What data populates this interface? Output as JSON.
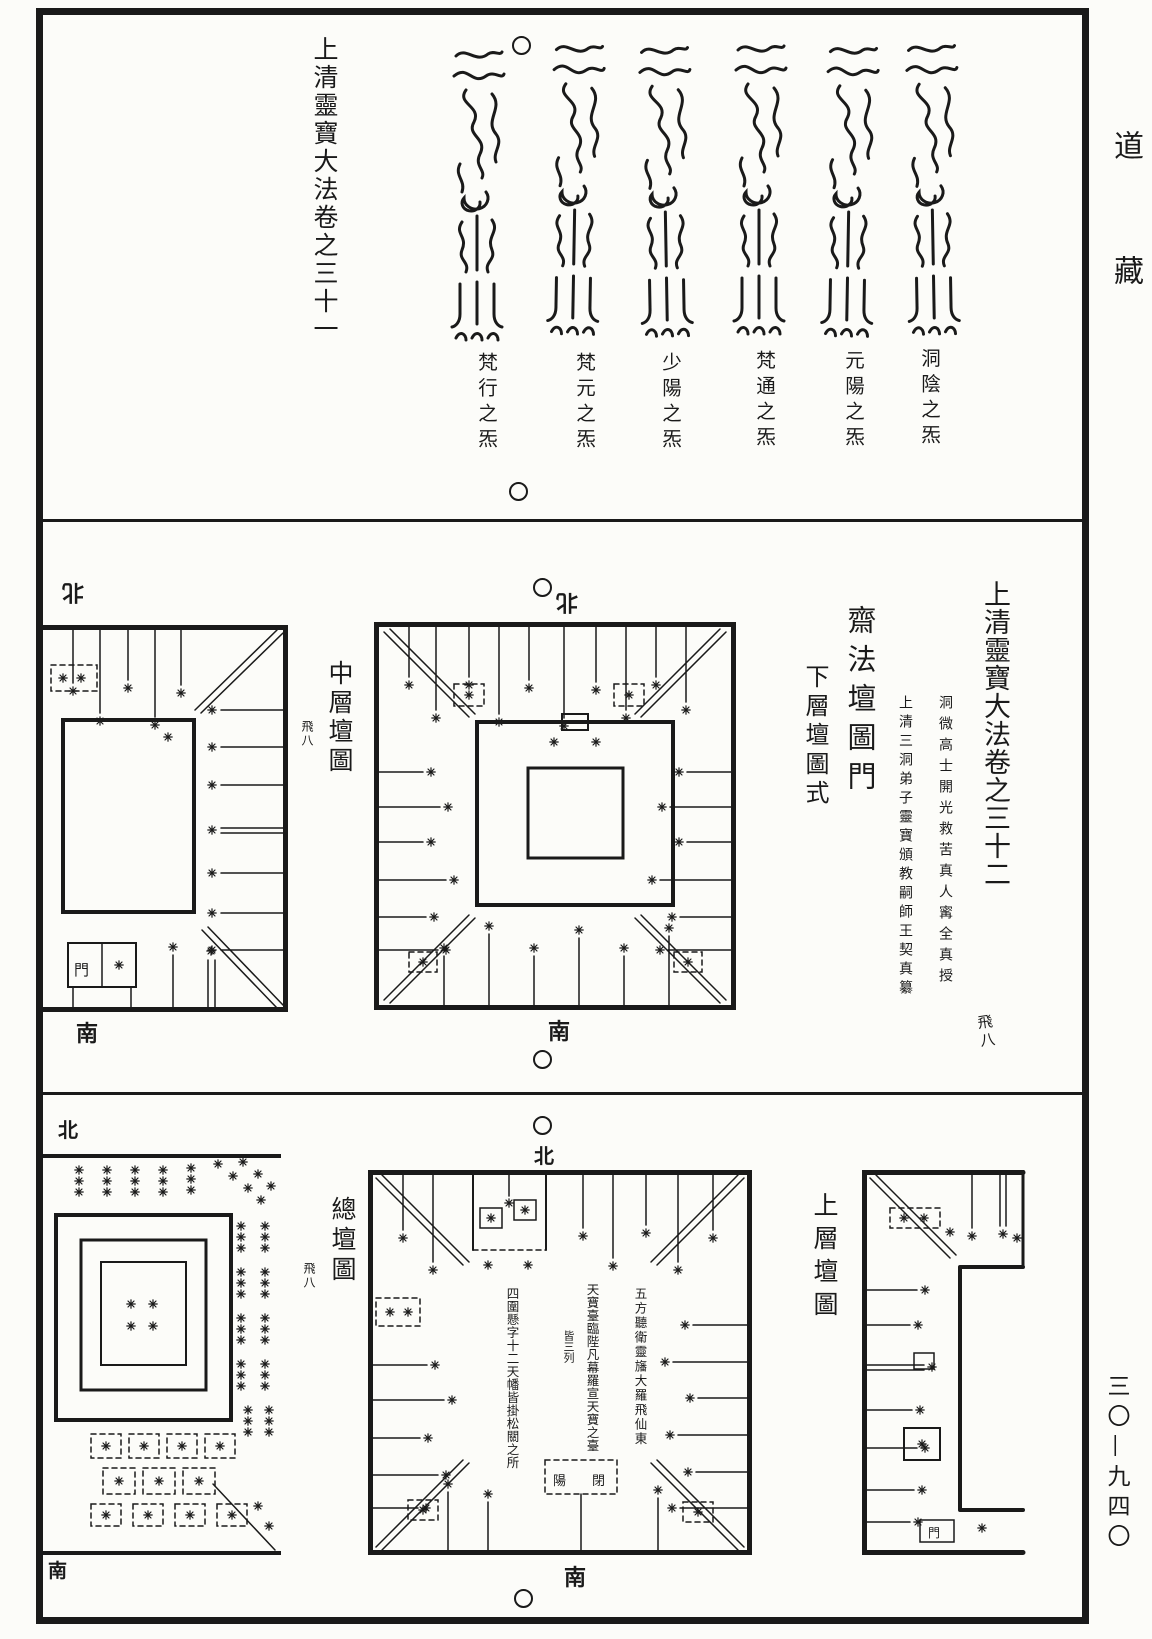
{
  "page": {
    "collection_label": "道藏",
    "page_number": "三〇—九四〇"
  },
  "top_section": {
    "volume_title": "上清靈寶大法卷之三十一",
    "talismans": [
      {
        "label": "梵行之炁"
      },
      {
        "label": "梵元之炁"
      },
      {
        "label": "少陽之炁"
      },
      {
        "label": "梵通之炁"
      },
      {
        "label": "元陽之炁"
      },
      {
        "label": "洞陰之炁"
      }
    ]
  },
  "middle_section": {
    "volume_title": "上清靈寶大法卷之三十二",
    "attribution_line_1": "洞微高士開光救苦真人寗全真授",
    "attribution_line_2": "上清三洞弟子靈寶頒教嗣師王契真纂",
    "chapter_title": "齋法壇圖門",
    "subsection_title": "下層壇圖式",
    "fascicle_marker": "飛八",
    "left_diagram": {
      "title": "中層壇圖",
      "fascicle_marker": "飛八",
      "north_label": "北",
      "south_label": "南",
      "gate_label": "門"
    },
    "center_diagram": {
      "north_label": "北",
      "south_label": "南"
    }
  },
  "bottom_section": {
    "left_diagram": {
      "title": "總壇圖",
      "fascicle_marker": "飛八",
      "north_label": "北",
      "south_label": "南"
    },
    "center_diagram": {
      "north_label": "北",
      "south_label": "南",
      "annotation_left": "四圍懸字十二天幡皆掛松關之所",
      "annotation_center": "天寶臺臨陛凡幕羅宣天寶之臺",
      "annotation_center_note": "皆三列",
      "annotation_right": "五方聽衛靈旛大羅飛仙東",
      "gate_label_left": "陽",
      "gate_label_right": "閉"
    },
    "right_diagram": {
      "title": "上層壇圖",
      "gate_label": "門"
    }
  }
}
